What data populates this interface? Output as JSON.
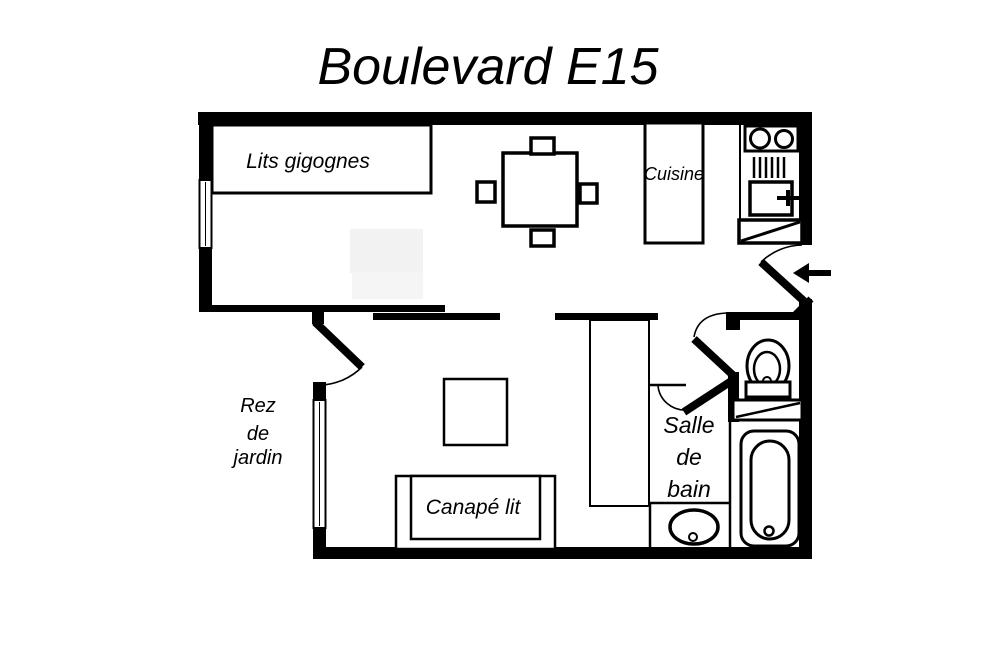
{
  "title": "Boulevard E15",
  "labels": {
    "beds": "Lits gigognes",
    "kitchen": "Cuisine",
    "sofa": "Canapé lit",
    "garden": {
      "line1": "Rez",
      "line2": "de",
      "line3": "jardin"
    },
    "bathroom": {
      "line1": "Salle",
      "line2": "de",
      "line3": "bain"
    }
  },
  "colors": {
    "ink": "#000000",
    "paper": "#ffffff",
    "ghost": "#f2f2f2"
  },
  "fixtures": {
    "dining_chairs_count": 4,
    "items": [
      "stacking-beds",
      "dining-table",
      "kitchen-counter",
      "cooktop-sink",
      "dish-drainer",
      "appliance-with-handle",
      "entry-closet",
      "entrance-door",
      "entrance-arrow",
      "interior-door",
      "bathroom-door",
      "wc-door",
      "wardrobe",
      "coffee-table",
      "sofa-bed",
      "toilet",
      "vanity-shelf",
      "bathtub",
      "washbasin",
      "bedroom-window",
      "living-room-window"
    ]
  }
}
